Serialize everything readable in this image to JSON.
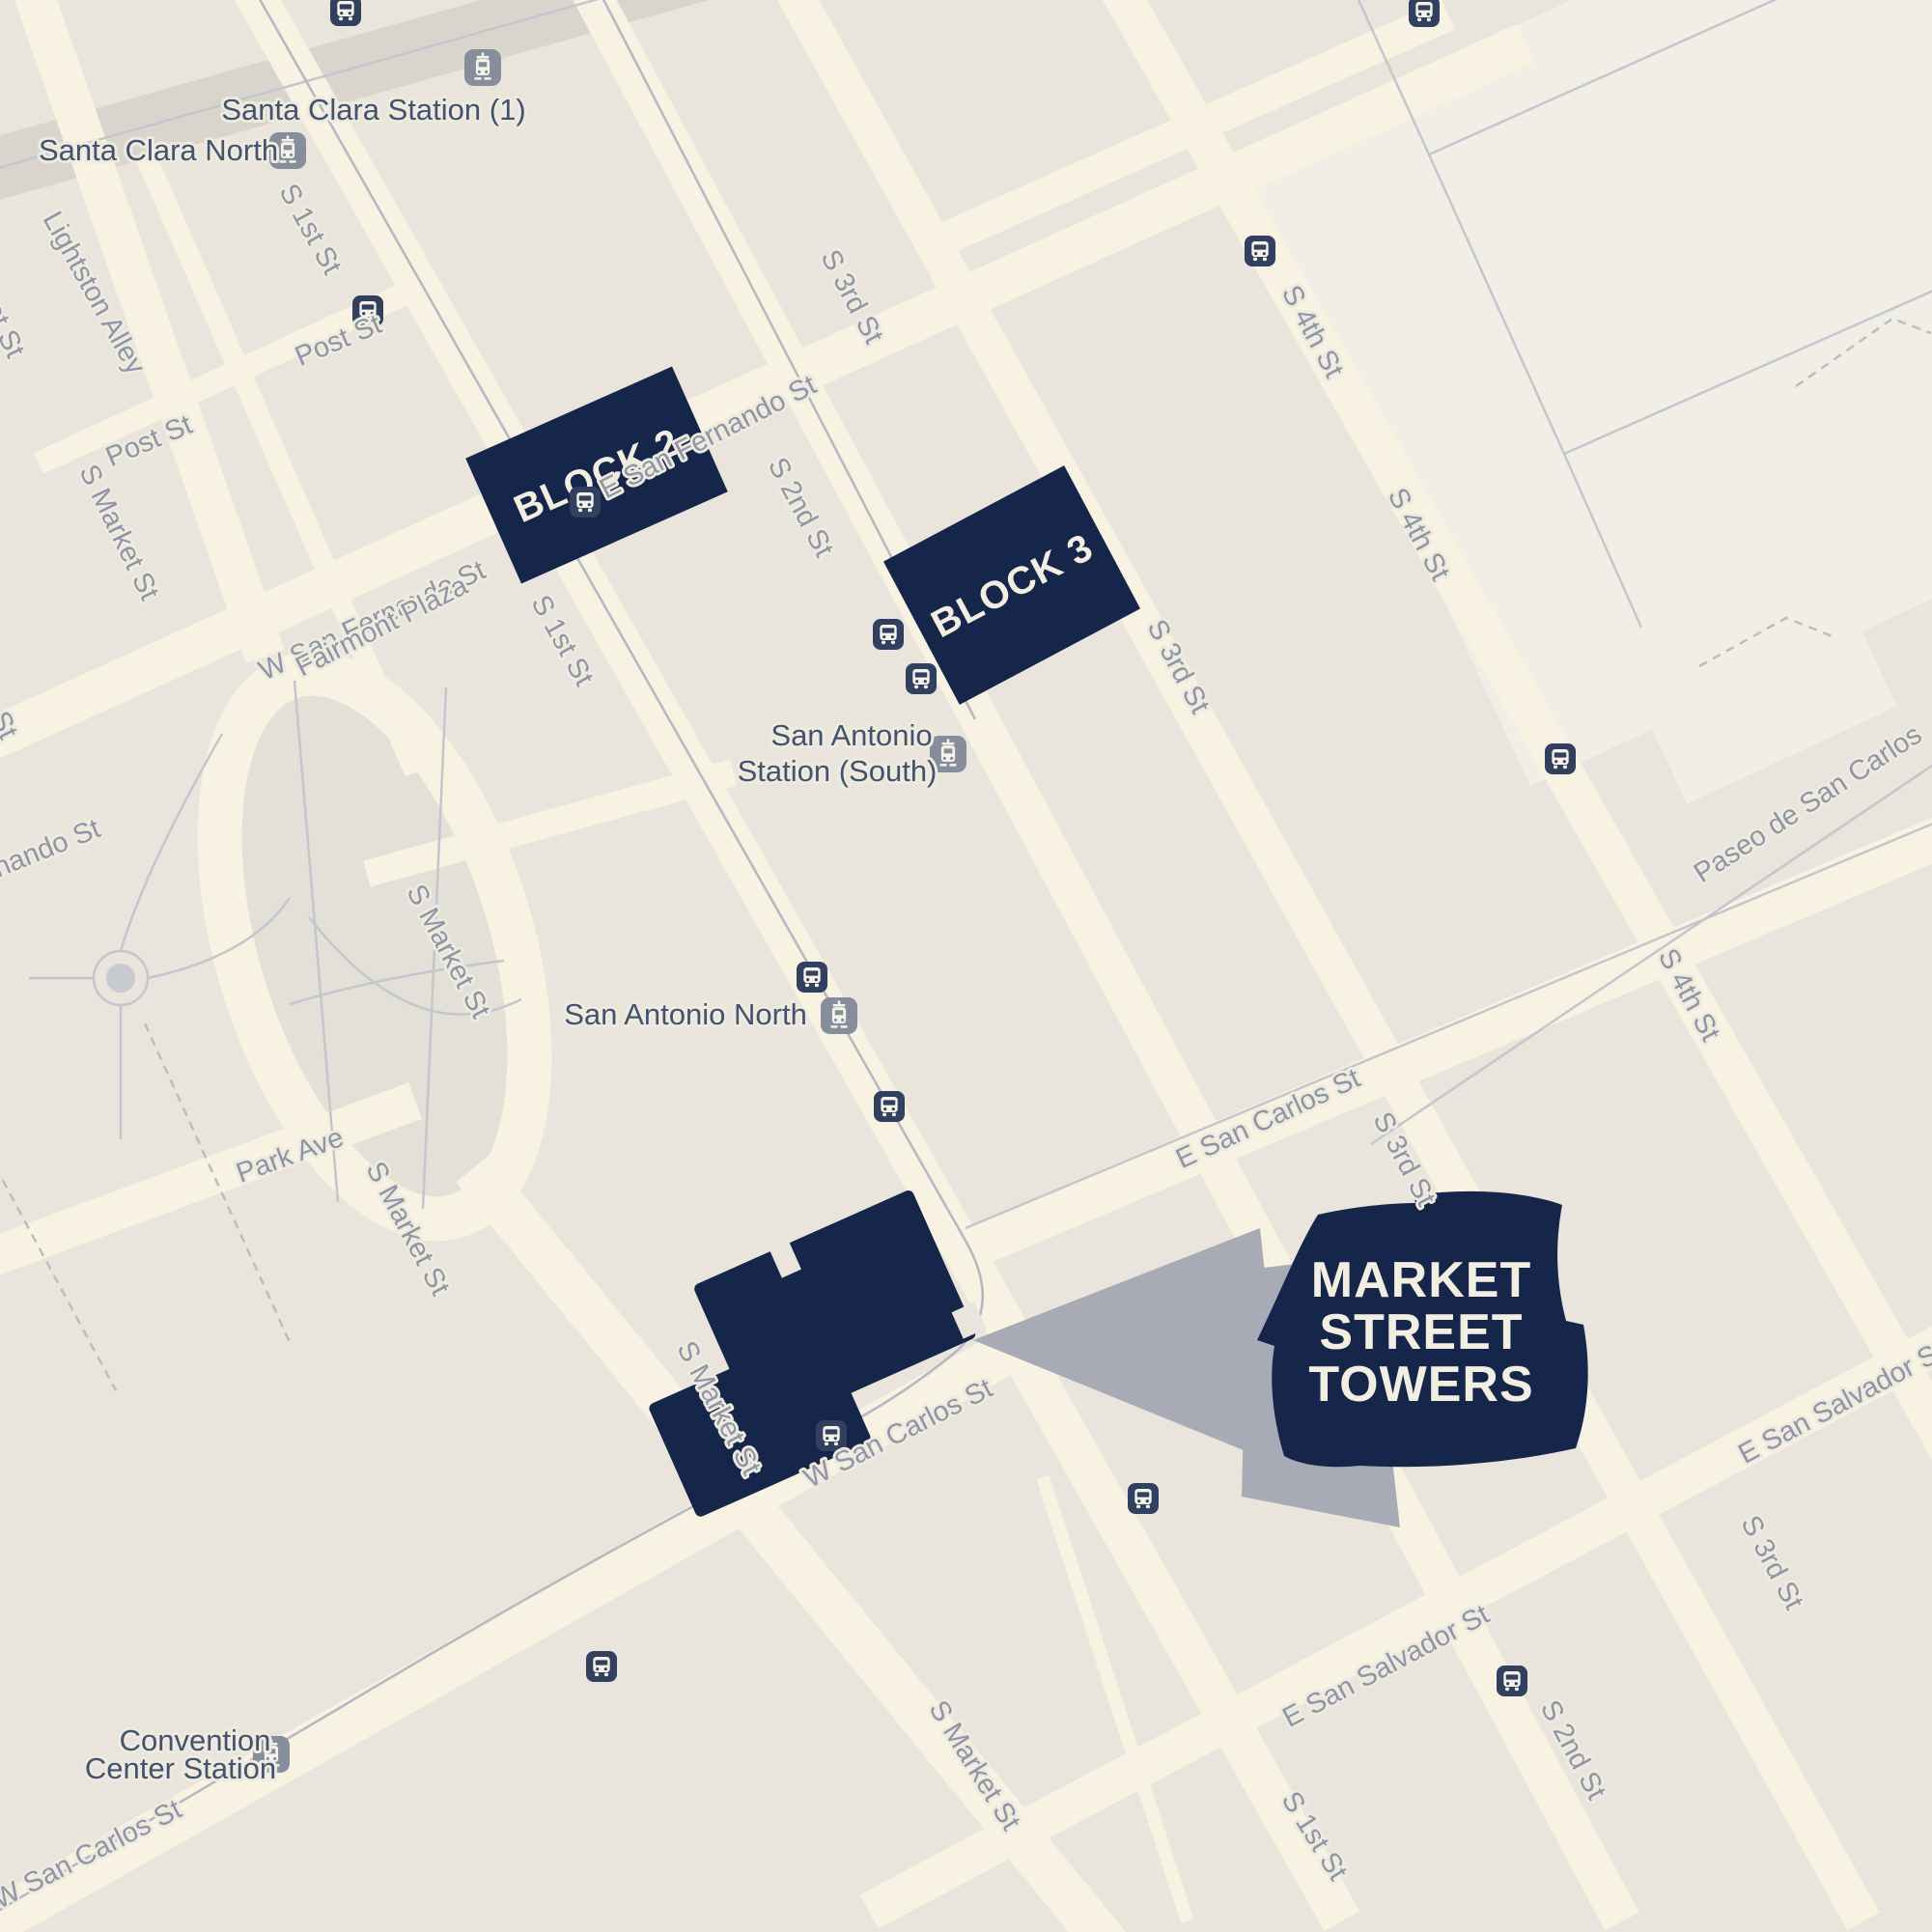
{
  "overlay": {
    "block2": "BLOCK 2",
    "block3": "BLOCK 3",
    "badge_line1": "MARKET",
    "badge_line2": "STREET",
    "badge_line3": "TOWERS"
  },
  "stations": {
    "santa_clara_1": "Santa Clara Station (1)",
    "santa_clara_north": "Santa Clara North",
    "san_antonio_south_line1": "San Antonio",
    "san_antonio_south_line2": "Station (South)",
    "san_antonio_north": "San Antonio North",
    "convention_line1": "Convention",
    "convention_line2": "Center Station"
  },
  "streets": {
    "s_market": "S Market St",
    "s_pedro": "S Pedro St",
    "fernando": "Fernando St",
    "s_1st": "S 1st St",
    "s_2nd": "S 2nd St",
    "s_3rd": "S 3rd St",
    "s_4th": "S 4th St",
    "post": "Post St",
    "lightston": "Lightston Alley",
    "w_san_fernando": "W San Fernando St",
    "e_san_fernando": "E San Fernando St",
    "w_san_carlos": "W San Carlos St",
    "e_san_carlos": "E San Carlos St",
    "e_san_salvador": "E San Salvador St",
    "park_ave": "Park Ave",
    "fairmont": "Fairmont Plaza",
    "paseo": "Paseo de San Carlos"
  },
  "icons": {
    "bus": "bus-stop-icon",
    "rail": "light-rail-station-icon"
  },
  "colors": {
    "background": "#e9e5dd",
    "road": "#f8f2e2",
    "navy": "#16264a",
    "badge_text": "#f3eee2",
    "street_label": "#8d95a7",
    "station_label": "#42526f",
    "bus_icon": "#32405f",
    "rail_icon": "#868d9b",
    "pointer_gray": "#a8abb5",
    "park": "#e3e0d8"
  }
}
